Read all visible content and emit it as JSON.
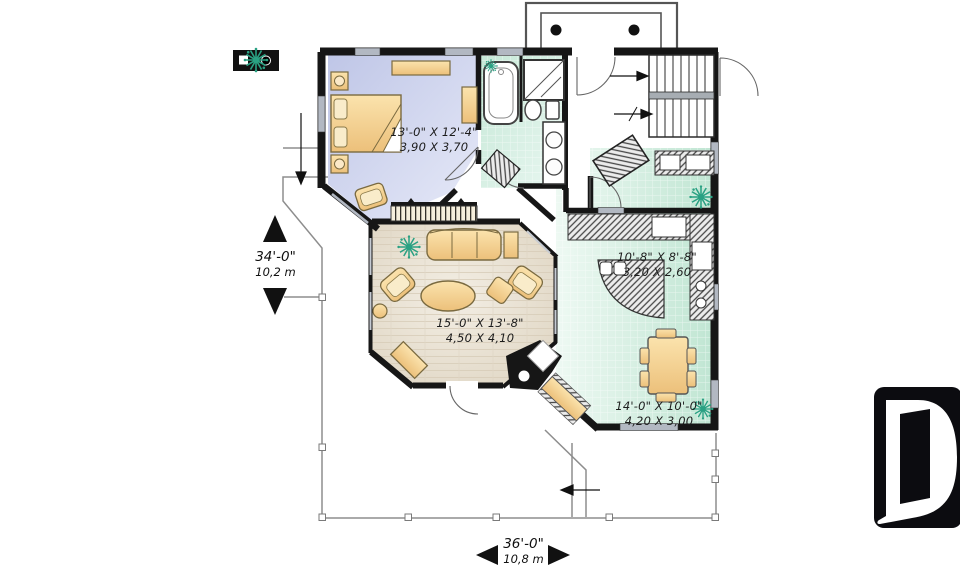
{
  "plan": {
    "rooms": [
      {
        "name": "bedroom",
        "imperial": "13'-0\" X 12'-4\"",
        "metric": "3,90 X 3,70"
      },
      {
        "name": "living-room",
        "imperial": "15'-0\" X 13'-8\"",
        "metric": "4,50 X 4,10"
      },
      {
        "name": "kitchen",
        "imperial": "10'-8\" X 8'-8\"",
        "metric": "3,20 X 2,60"
      },
      {
        "name": "dining-room",
        "imperial": "14'-0\" X 10'-0\"",
        "metric": "4,20 X 3,00"
      }
    ],
    "overall": {
      "depth": {
        "imperial": "34'-0\"",
        "metric": "10,2 m"
      },
      "width": {
        "imperial": "36'-0\"",
        "metric": "10,8 m"
      }
    }
  },
  "logo": {
    "letter": "D"
  },
  "colors": {
    "wall": "#161616",
    "bedroom_floor": "#c9cfeb",
    "tile_floor": "#cdeadd",
    "wood_floor": "#e9e1d2",
    "furniture": "#f2cf8f",
    "plant": "#2aa183",
    "logo_bg": "#0c0c10"
  }
}
